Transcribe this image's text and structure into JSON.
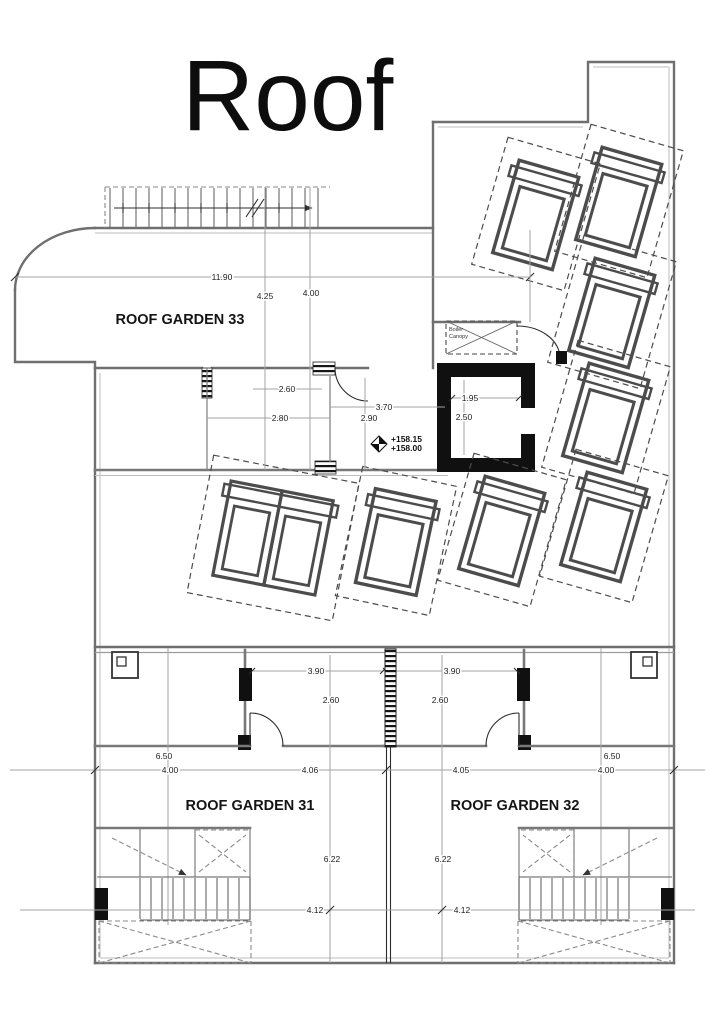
{
  "title": "Roof",
  "rooms": {
    "garden33": "ROOF GARDEN 33",
    "garden31": "ROOF GARDEN 31",
    "garden32": "ROOF GARDEN 32"
  },
  "annotations": {
    "boiler_line1": "Boiler",
    "boiler_line2": "Canopy",
    "level_upper": "+158.15",
    "level_lower": "+158.00"
  },
  "dims": {
    "top_width": "11.90",
    "h_left": "4.25",
    "h_right": "4.00",
    "room_260": "2.60",
    "room_280": "2.80",
    "corr_370": "3.70",
    "corr_290": "2.90",
    "lift_w": "1.95",
    "lift_d": "2.50",
    "vest_w_l": "3.90",
    "vest_d_l": "2.60",
    "vest_w_r": "3.90",
    "vest_d_r": "2.60",
    "side_650_l": "6.50",
    "side_400_l": "4.00",
    "mid_406": "4.06",
    "mid_405": "4.05",
    "side_650_r": "6.50",
    "side_400_r": "4.00",
    "len_622_l": "6.22",
    "len_622_r": "6.22",
    "len_412_l": "4.12",
    "len_412_r": "4.12"
  }
}
